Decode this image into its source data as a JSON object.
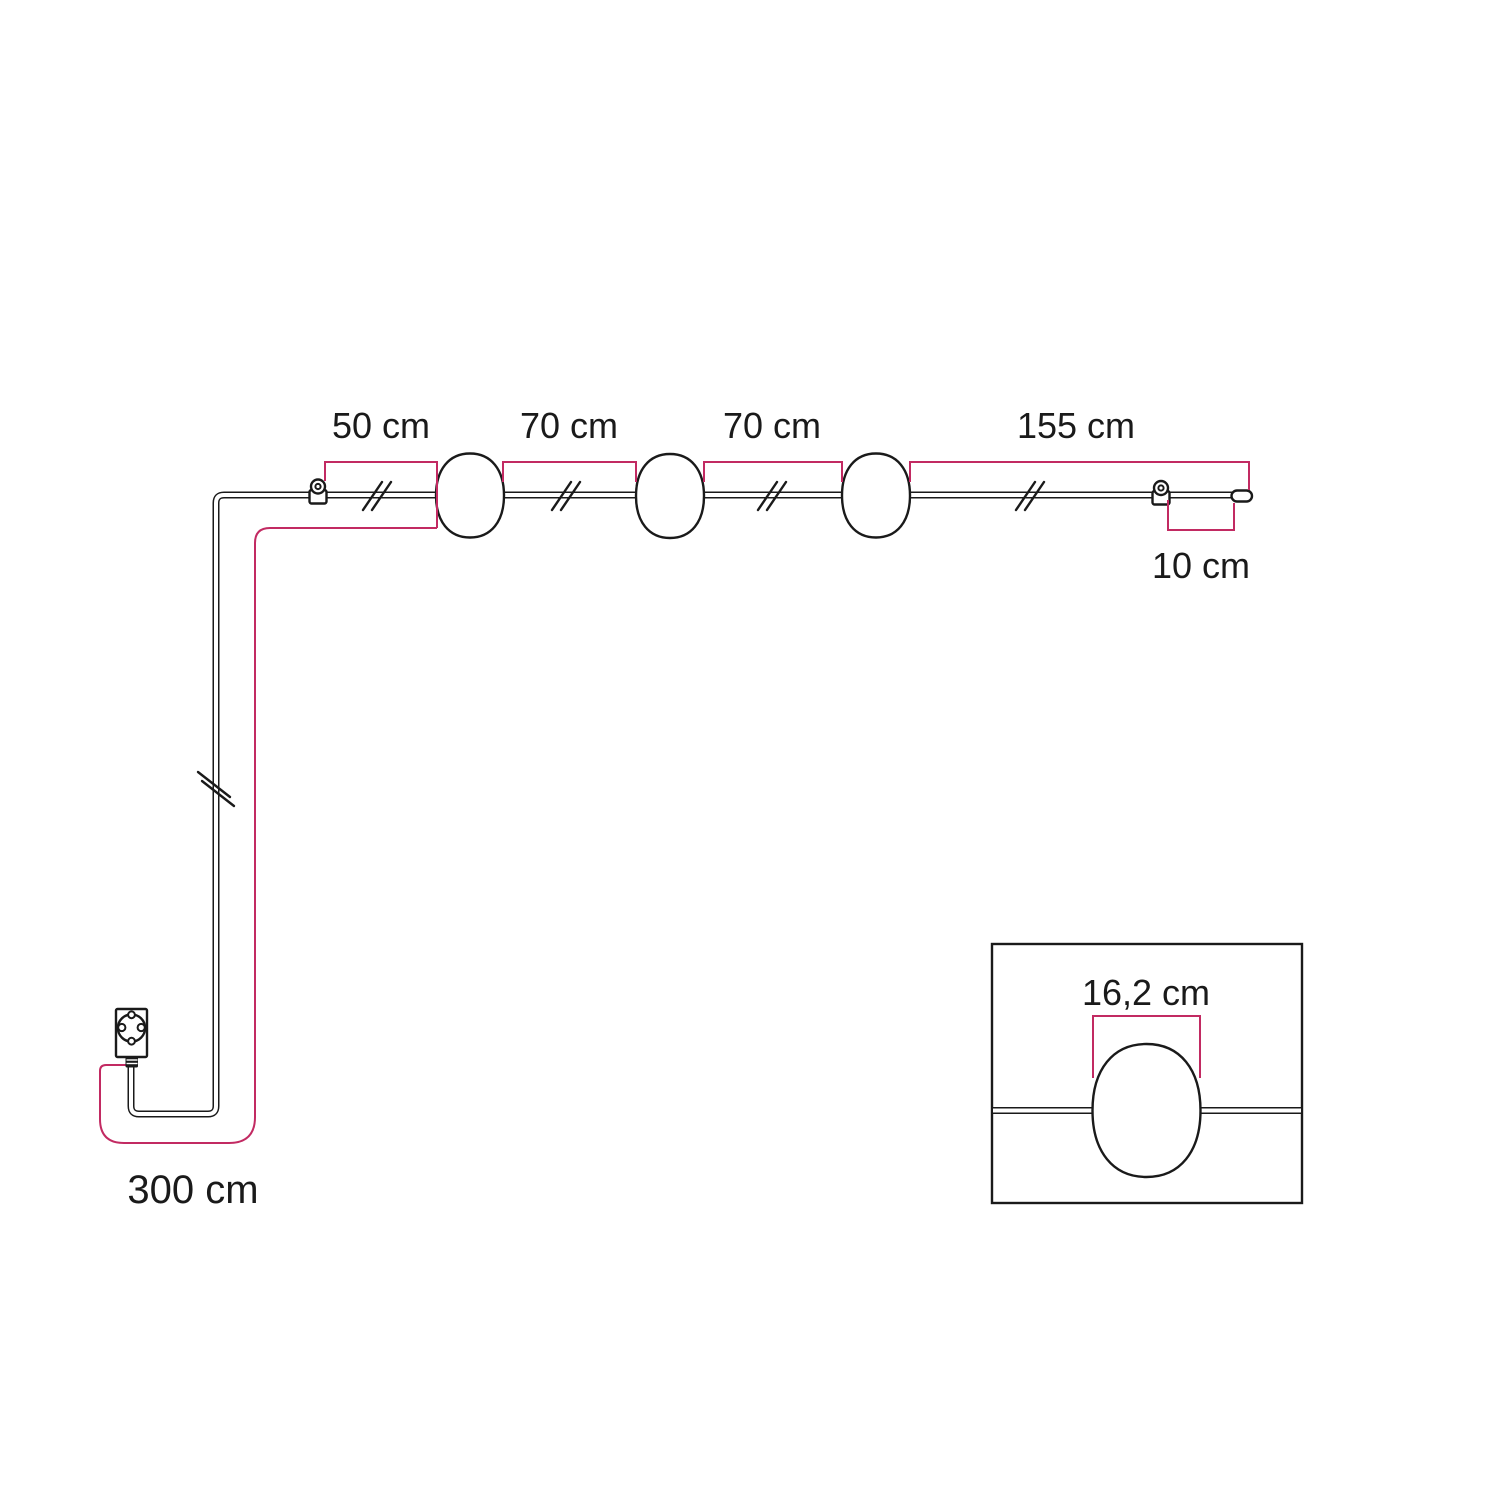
{
  "colors": {
    "accent": "#c22a62",
    "line": "#1a1a1a",
    "background": "#ffffff"
  },
  "diagram": {
    "type": "product-dimension-diagram",
    "subject": "string-light cable with three pendant lampshades, wall hooks and power plug",
    "dimensions": {
      "hook_to_first_lamp": "50 cm",
      "first_to_second_lamp": "70 cm",
      "second_to_third_lamp": "70 cm",
      "third_lamp_to_end_hook": "155 cm",
      "end_tail": "10 cm",
      "plug_to_first_hook": "300 cm",
      "lampshade_width": "16,2 cm"
    }
  }
}
